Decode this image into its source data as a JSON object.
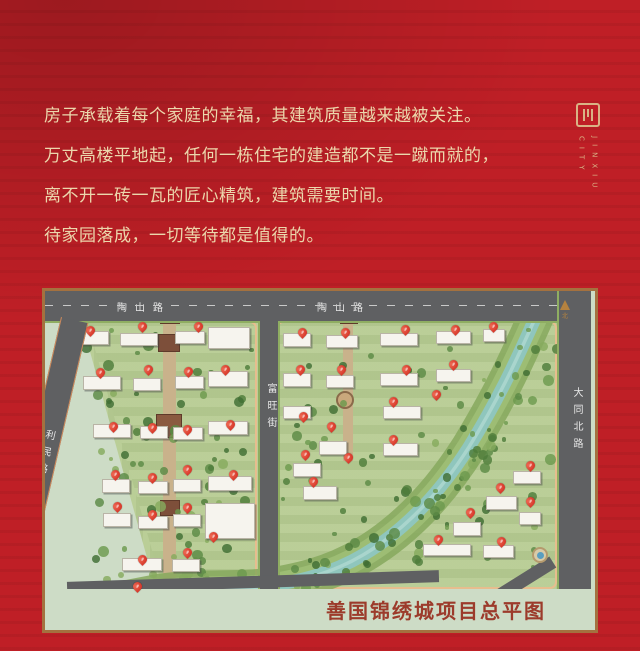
{
  "colors": {
    "bg": "#bf1f26",
    "text_gold": "#ecd7ac",
    "logo_gold": "#d9b385",
    "frame": "#a4713f",
    "road": "#5f6062",
    "parcel": "#b7cc93",
    "strip": "#cddcc6",
    "water": "#8fc6bd",
    "bank": "#86a85d",
    "pin": "#cf241a",
    "title": "#9c3b2b",
    "sidewalk": "#e7bd8e"
  },
  "intro": {
    "lines": [
      "房子承载着每个家庭的幸福，其建筑质量越来越被关注。",
      "万丈高楼平地起，任何一栋住宅的建造都不是一蹴而就的，",
      "离不开一砖一瓦的匠心精筑，建筑需要时间。",
      "待家园落成，一切等待都是值得的。"
    ]
  },
  "logo": {
    "line1": "JINXIU",
    "line2": "CITY"
  },
  "map": {
    "title": "善国锦绣城项目总平图",
    "north_label": "北",
    "pin_label": "#",
    "roads": {
      "top_left": "陶山路",
      "top_right": "陶山路",
      "left": "利民路",
      "middle": "富旺街",
      "right": "大同北路"
    },
    "buildings": [
      [
        20,
        40,
        44,
        14
      ],
      [
        75,
        42,
        38,
        13
      ],
      [
        130,
        40,
        30,
        13
      ],
      [
        163,
        36,
        42,
        22
      ],
      [
        38,
        85,
        38,
        14
      ],
      [
        88,
        87,
        28,
        13
      ],
      [
        130,
        85,
        29,
        13
      ],
      [
        163,
        80,
        40,
        16
      ],
      [
        48,
        133,
        38,
        14
      ],
      [
        95,
        135,
        28,
        13
      ],
      [
        128,
        136,
        30,
        13
      ],
      [
        163,
        130,
        40,
        14
      ],
      [
        57,
        188,
        28,
        14
      ],
      [
        93,
        190,
        30,
        13
      ],
      [
        128,
        188,
        28,
        13
      ],
      [
        163,
        185,
        44,
        15
      ],
      [
        58,
        222,
        28,
        14
      ],
      [
        93,
        225,
        30,
        13
      ],
      [
        128,
        223,
        28,
        13
      ],
      [
        160,
        212,
        50,
        36
      ],
      [
        77,
        267,
        40,
        13
      ],
      [
        127,
        268,
        28,
        13
      ],
      [
        76,
        293,
        34,
        12
      ],
      [
        238,
        42,
        28,
        14
      ],
      [
        281,
        44,
        32,
        13
      ],
      [
        335,
        42,
        38,
        13
      ],
      [
        391,
        40,
        35,
        13
      ],
      [
        438,
        38,
        22,
        13
      ],
      [
        238,
        82,
        28,
        14
      ],
      [
        281,
        84,
        28,
        13
      ],
      [
        335,
        82,
        38,
        13
      ],
      [
        391,
        78,
        35,
        13
      ],
      [
        238,
        115,
        28,
        13
      ],
      [
        338,
        115,
        38,
        13
      ],
      [
        274,
        150,
        28,
        14
      ],
      [
        338,
        152,
        35,
        13
      ],
      [
        248,
        172,
        28,
        14
      ],
      [
        258,
        195,
        34,
        14
      ],
      [
        468,
        180,
        28,
        13
      ],
      [
        441,
        205,
        31,
        14
      ],
      [
        474,
        221,
        22,
        13
      ],
      [
        408,
        231,
        28,
        14
      ],
      [
        378,
        253,
        48,
        12
      ],
      [
        438,
        254,
        31,
        13
      ]
    ],
    "pins": [
      [
        45,
        46
      ],
      [
        97,
        42
      ],
      [
        153,
        42
      ],
      [
        55,
        88
      ],
      [
        103,
        85
      ],
      [
        143,
        87
      ],
      [
        180,
        85
      ],
      [
        68,
        142
      ],
      [
        107,
        143
      ],
      [
        142,
        145
      ],
      [
        185,
        140
      ],
      [
        70,
        190
      ],
      [
        107,
        193
      ],
      [
        142,
        185
      ],
      [
        188,
        190
      ],
      [
        72,
        222
      ],
      [
        107,
        230
      ],
      [
        142,
        223
      ],
      [
        168,
        252
      ],
      [
        97,
        275
      ],
      [
        142,
        268
      ],
      [
        92,
        302
      ],
      [
        257,
        48
      ],
      [
        300,
        48
      ],
      [
        360,
        45
      ],
      [
        410,
        45
      ],
      [
        448,
        42
      ],
      [
        255,
        85
      ],
      [
        296,
        85
      ],
      [
        361,
        85
      ],
      [
        408,
        80
      ],
      [
        258,
        132
      ],
      [
        286,
        142
      ],
      [
        348,
        117
      ],
      [
        391,
        110
      ],
      [
        348,
        155
      ],
      [
        260,
        170
      ],
      [
        303,
        173
      ],
      [
        268,
        197
      ],
      [
        455,
        203
      ],
      [
        485,
        181
      ],
      [
        485,
        217
      ],
      [
        425,
        228
      ],
      [
        393,
        255
      ],
      [
        456,
        257
      ]
    ]
  }
}
